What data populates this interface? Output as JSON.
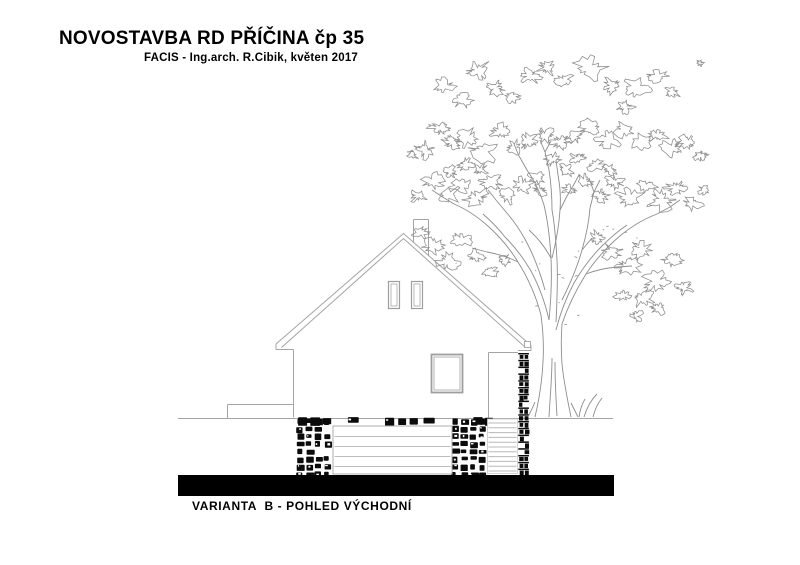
{
  "header": {
    "title": "NOVOSTAVBA RD PŘÍČINA čp 35",
    "subtitle": "FACIS - Ing.arch. R.Cibik, květen 2017"
  },
  "footer": {
    "caption": "VARIANTA  B - POHLED VÝCHODNÍ"
  },
  "drawing": {
    "type": "architectural-elevation-sketch",
    "subject": "east elevation of a gabled house with stone basement, garage door, stone corner column and a large deciduous tree",
    "colors": {
      "paper": "#ffffff",
      "outline": "#a4a4a4",
      "tree_line": "#8d8d8d",
      "stone": "#0b0b0b",
      "ground_bar": "#000000",
      "door_line": "#bdbdbd",
      "siding_line": "#b8b8b8",
      "text": "#000000"
    }
  }
}
